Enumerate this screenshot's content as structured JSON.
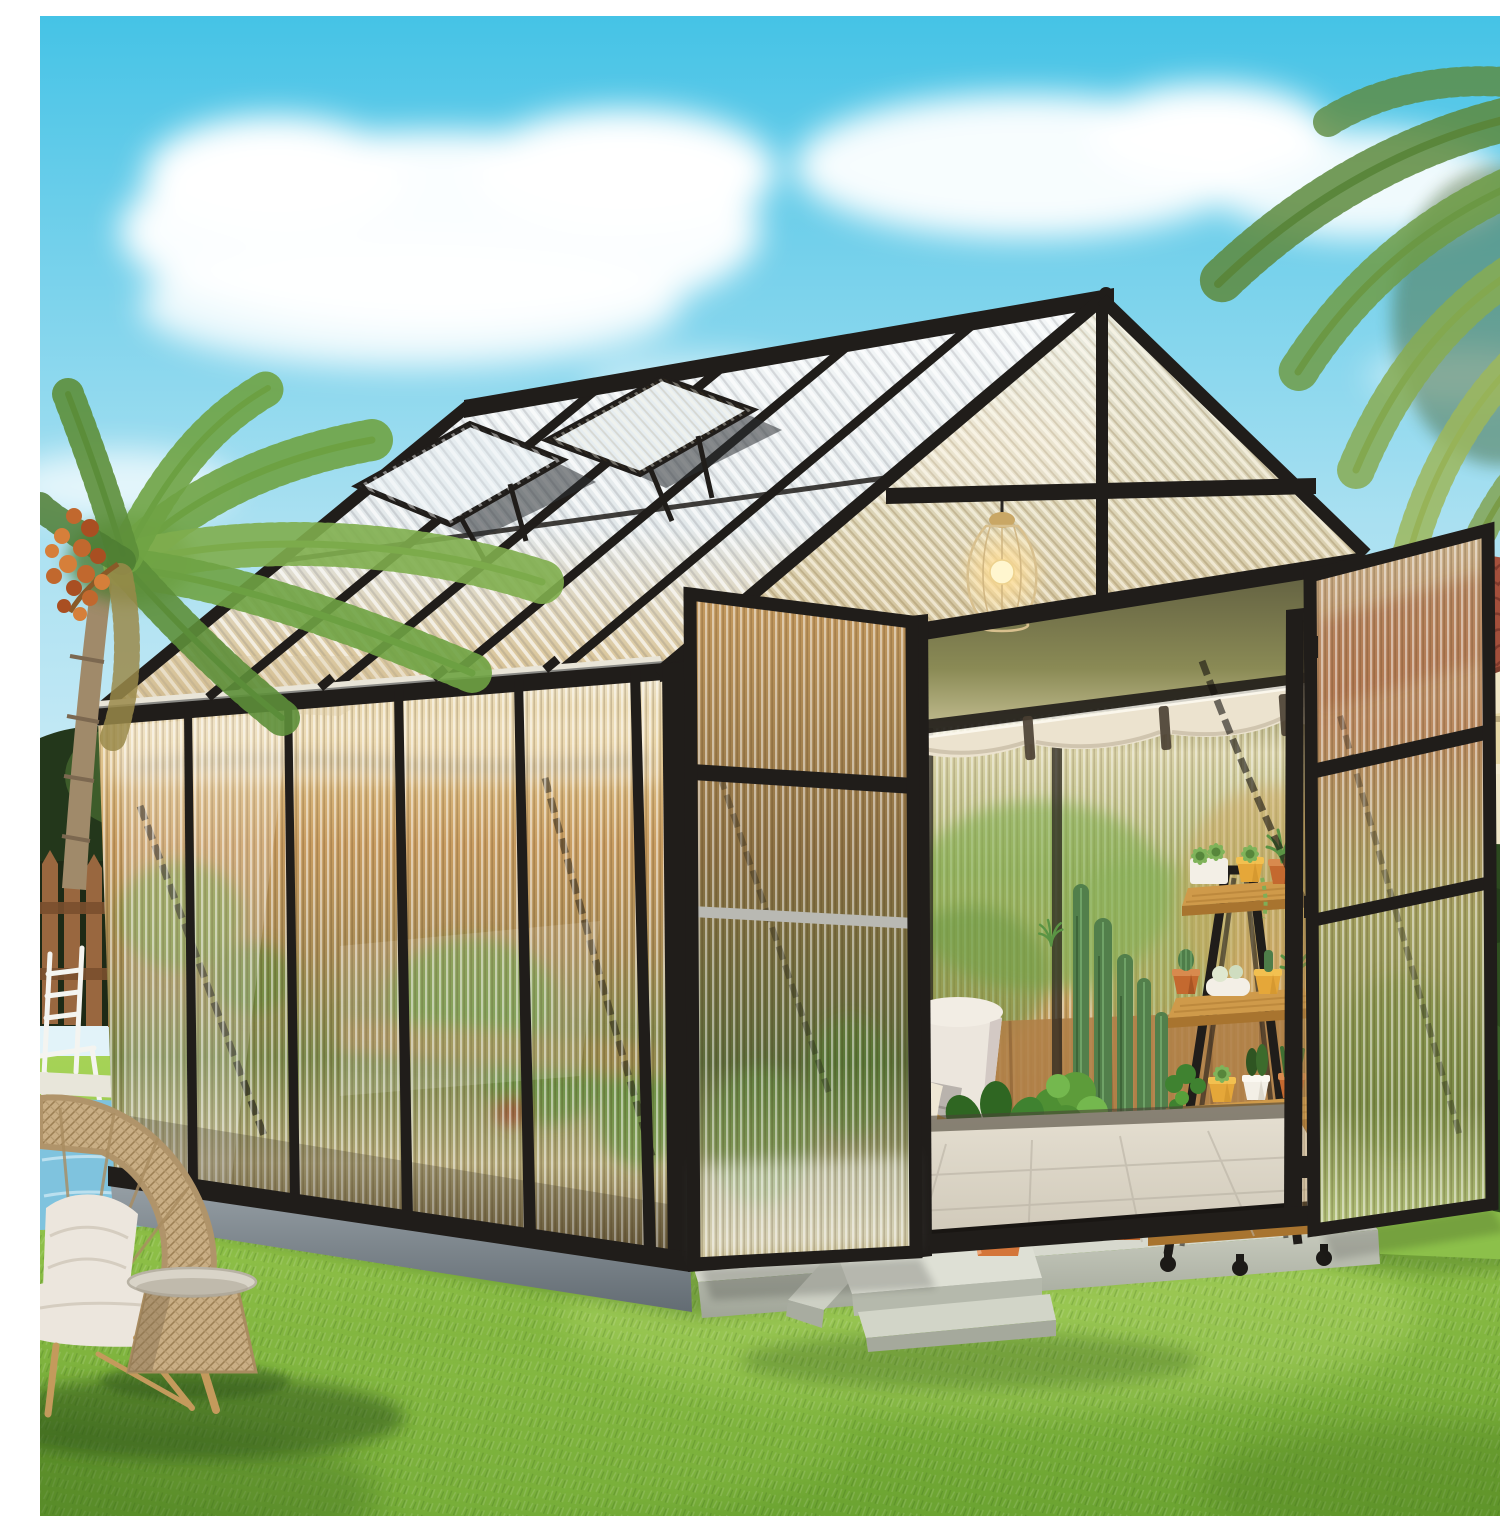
{
  "image": {
    "domain": "natural-image",
    "width": 1500,
    "height": 1500,
    "alt": "Sunny backyard product photo of a black aluminum greenhouse with corrugated translucent polycarbonate panels on a concrete pad. Both front doors are swung open showing a cushioned lounge chair with a knit throw, columnar cacti, a fiddle-leaf fig in a terracotta pot, wooden stools, a 4-tier wooden ladder plant stand full of potted succulents, a white watering can and a glowing wire-cage pendant lamp under a rolled-up cream shade. Two roof vent windows are propped open. Around it: a bright green lawn, a rattan fan-back chair with white cushions and a round rattan side table, a palm tree with orange date clusters, a brown picket fence with a small pool, and a cream stucco house with a terracotta tile roof under a blue sky with white clouds."
  },
  "colors": {
    "sky_top": "#45c3e6",
    "sky_mid": "#a9e0f1",
    "sky_low": "#e2f3f9",
    "cloud": "#ffffff",
    "grass_light": "#a6d357",
    "grass_dark": "#6ba331",
    "frame": "#201d1a",
    "panel_amber": "#c89c60",
    "shade": "#ece3cf",
    "wood": "#c8914a",
    "terracotta": "#c4692f",
    "foliage": "#4e8f33",
    "cactus": "#527f4b",
    "house_roof": "#a4503c",
    "house_wall": "#e6d7a6",
    "pool": "#7fc3de",
    "fence": "#99673f",
    "wicker": "#c3a87e",
    "cushion": "#ece6dd",
    "concrete_light": "#d7d9ce",
    "concrete_shadow": "#79828a",
    "lamp_glow": "#ffd98c"
  },
  "scene": {
    "setting": "sunny backyard lawn",
    "sky": {
      "clouds": 6
    },
    "background_left": [
      "palm tree with orange date cluster",
      "dark garden trees",
      "brown wooden picket fence",
      "white pool chair",
      "swimming pool edge"
    ],
    "background_right": [
      "dense palm canopy",
      "cream stucco house with terracotta tile roof, cornice and column",
      "dark green shrubs"
    ],
    "greenhouse": {
      "frame": "black aluminum",
      "glazing": "corrugated translucent polycarbonate",
      "wall_bays_left": 5,
      "roof_vents_open": 2,
      "doors_open": 2,
      "rafters": 4,
      "wind_braces": "black diagonal braces visible through panels",
      "interior": [
        "wire cage pendant lamp, lit",
        "rolled-up cream shade under rear eave",
        "cream cushion lounge chair with wood arms, gray pillow and knit throw",
        "fiddle-leaf fig in bright terracotta pot",
        "aloe plant",
        "bushy plant on wooden stool",
        "second wooden stool",
        "columnar cacti group",
        "large terracotta pots",
        "4-tier wooden ladder plant stand on casters",
        "potted succulents and cacti in white, yellow and terracotta pots",
        "white watering can",
        "light paved floor"
      ]
    },
    "midground": [
      "concrete foundation slab",
      "concrete steps with sloped side wedge"
    ],
    "foreground": [
      "rattan fan-back chair with white cushions",
      "round rattan side table",
      "bright green lawn"
    ]
  }
}
